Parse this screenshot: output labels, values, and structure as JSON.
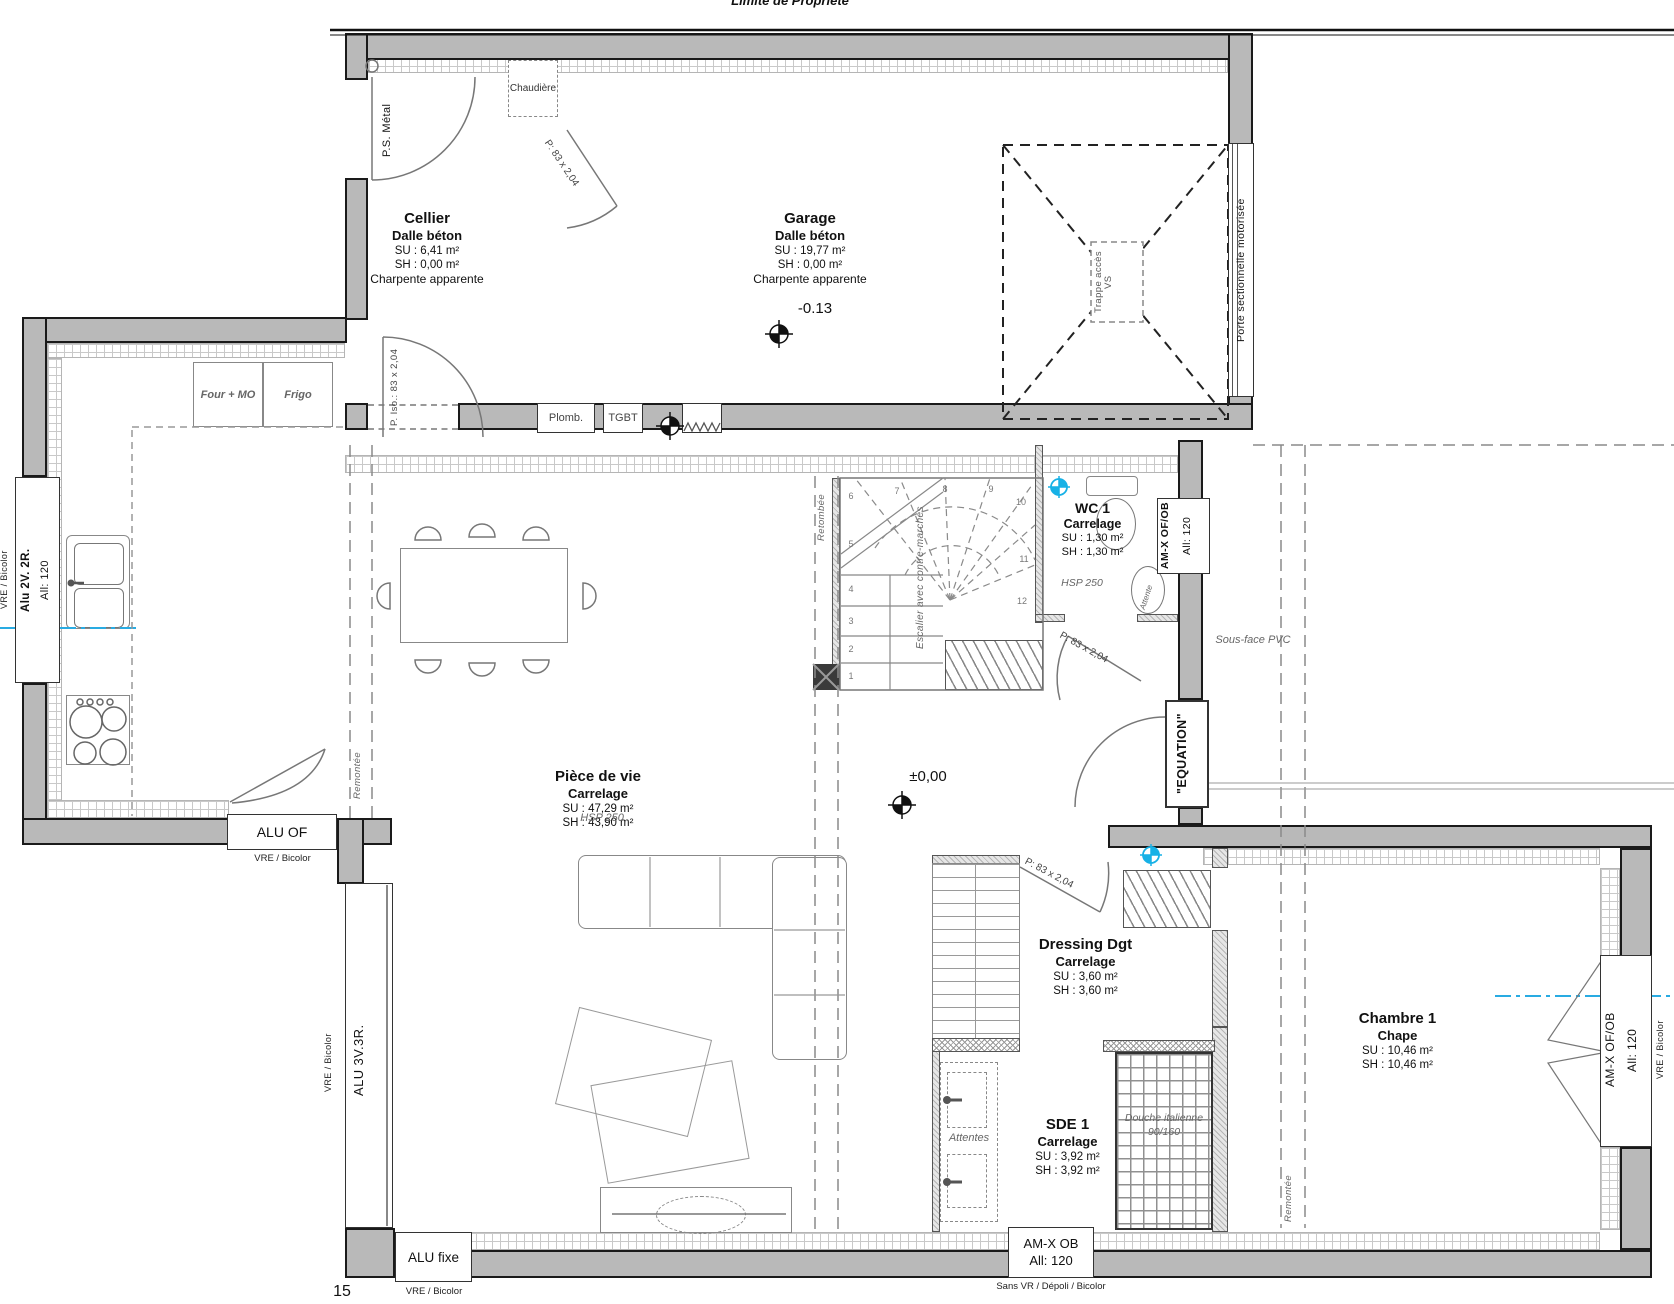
{
  "meta": {
    "property_line": "Limite de Propriété",
    "page": "15"
  },
  "colors": {
    "wall_fill": "#b9b9b9",
    "section_line": "#29abe2"
  },
  "levels": {
    "garage": "-0.13",
    "ground": "±0,00"
  },
  "common": {
    "vre_bicolor": "VRE / Bicolor",
    "all_120": "All: 120",
    "p83": "P: 83 x 2,04",
    "hsp": "HSP 250"
  },
  "rooms": {
    "cellier": {
      "name": "Cellier",
      "floor": "Dalle béton",
      "su": "SU : 6,41 m²",
      "sh": "SH : 0,00 m²",
      "note": "Charpente apparente"
    },
    "garage": {
      "name": "Garage",
      "floor": "Dalle béton",
      "su": "SU : 19,77 m²",
      "sh": "SH : 0,00 m²",
      "note": "Charpente apparente"
    },
    "piece_de_vie": {
      "name": "Pièce de vie",
      "floor": "Carrelage",
      "su": "SU : 47,29 m²",
      "sh": "SH : 43,90 m²"
    },
    "wc1": {
      "name": "WC 1",
      "floor": "Carrelage",
      "su": "SU : 1,30 m²",
      "sh": "SH : 1,30 m²"
    },
    "dressing": {
      "name": "Dressing Dgt",
      "floor": "Carrelage",
      "su": "SU : 3,60 m²",
      "sh": "SH : 3,60 m²"
    },
    "sde1": {
      "name": "SDE 1",
      "floor": "Carrelage",
      "su": "SU : 3,92 m²",
      "sh": "SH : 3,92 m²"
    },
    "chambre1": {
      "name": "Chambre 1",
      "floor": "Chape",
      "su": "SU : 10,46 m²",
      "sh": "SH : 10,46 m²"
    }
  },
  "windows": {
    "kitchen_left": {
      "label": "Alu 2V. 2R."
    },
    "kitchen_south": {
      "label": "ALU OF"
    },
    "bay": {
      "label": "ALU 3V.3R."
    },
    "fixed": {
      "label": "ALU fixe"
    },
    "sde": {
      "label": "AM-X OB",
      "note": "Sans VR / Dépoli / Bicolor"
    },
    "wc": {
      "label": "AM-X OF/OB"
    },
    "chambre": {
      "label": "AM-X OF/OB"
    }
  },
  "doors": {
    "ps_metal": "P.S. Métal",
    "iso": "P. Iso.: 83 x 2,04",
    "entry": "\"EQUATION\"",
    "garage_door": "Porte sectionnelle motorisée"
  },
  "stair": {
    "label": "Escalier avec contre-marches",
    "steps": [
      "1",
      "2",
      "3",
      "4",
      "5",
      "6",
      "7",
      "8",
      "9",
      "10",
      "11",
      "12"
    ]
  },
  "kitchen": {
    "four": "Four + MO",
    "frigo": "Frigo"
  },
  "equipment": {
    "chaudiere": "Chaudière",
    "plomb": "Plomb.",
    "tgbt": "TGBT",
    "trappe": "Trappe accès VS",
    "attentes": "Attentes",
    "attente": "Attente",
    "douche": "Douche italienne",
    "douche_dim": "90/160"
  },
  "annotations": {
    "retombee": "Retombée",
    "remontee": "Remontée",
    "sous_face": "Sous-face PVC"
  }
}
